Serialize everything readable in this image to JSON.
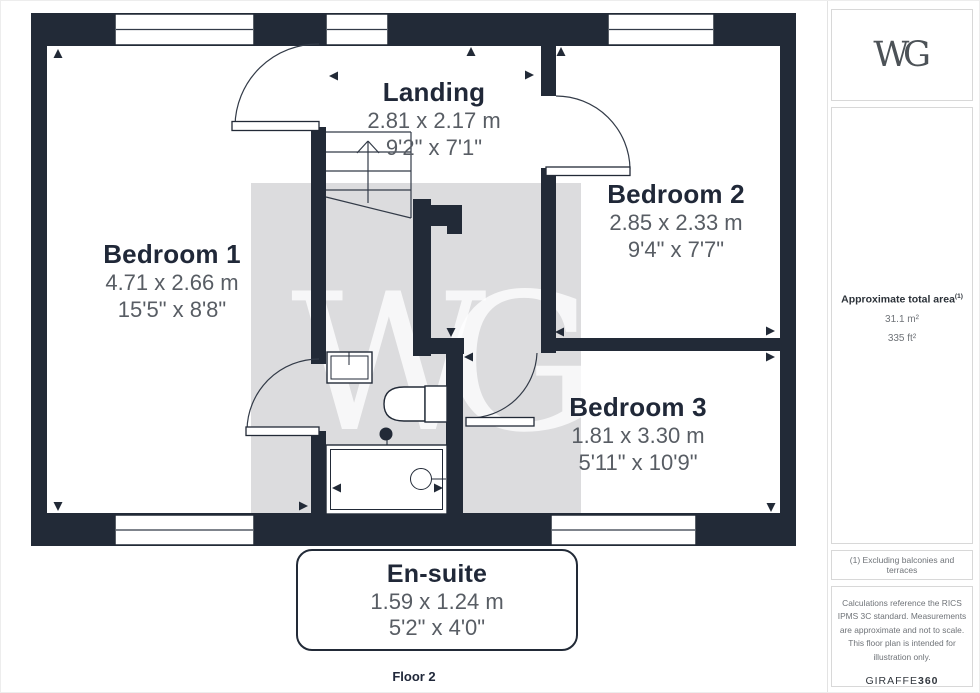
{
  "floorplan": {
    "floor_label": "Floor 2",
    "watermark": "WG",
    "rooms": [
      {
        "name": "Landing",
        "metric": "2.81 x 2.17 m",
        "imperial": "9'2\" x 7'1\""
      },
      {
        "name": "Bedroom 1",
        "metric": "4.71 x 2.66 m",
        "imperial": "15'5\" x 8'8\""
      },
      {
        "name": "Bedroom 2",
        "metric": "2.85 x 2.33 m",
        "imperial": "9'4\" x 7'7\""
      },
      {
        "name": "Bedroom 3",
        "metric": "1.81 x 3.30 m",
        "imperial": "5'11\" x 10'9\""
      },
      {
        "name": "En-suite",
        "metric": "1.59 x 1.24 m",
        "imperial": "5'2\" x 4'0\""
      }
    ]
  },
  "sidebar": {
    "logo": "WG",
    "area": {
      "title": "Approximate total area",
      "superscript": "(1)",
      "metric": "31.1 m²",
      "imperial": "335 ft²"
    },
    "footnote1": "(1) Excluding balconies and terraces",
    "disclaimer": "Calculations reference the RICS IPMS 3C standard. Measurements are approximate and not to scale. This floor plan is intended for illustration only.",
    "brand": {
      "name": "GIRAFFE",
      "suffix": "360"
    }
  },
  "colors": {
    "wall": "#222a37",
    "dimension_text": "#585d64",
    "room_title_text": "#202838",
    "watermark_background": "#dcdcde",
    "sidebar_border": "#d8d8d8"
  }
}
